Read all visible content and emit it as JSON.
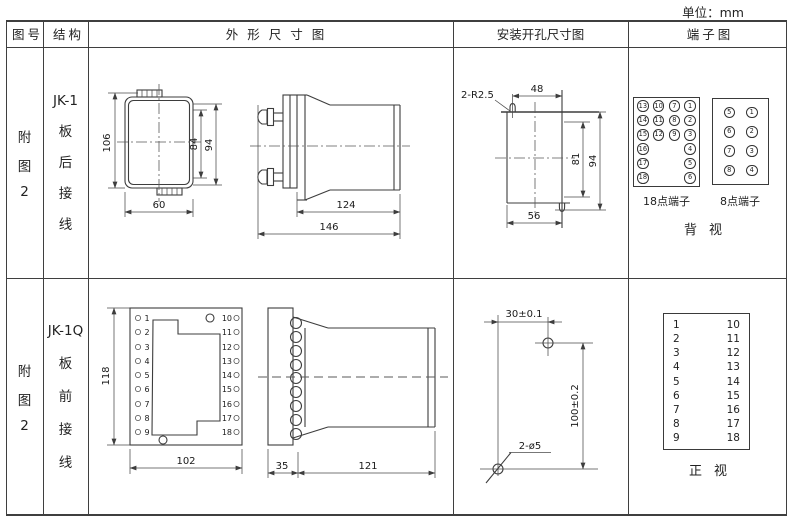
{
  "unit_label": "单位：mm",
  "header": {
    "figure_col": "图号",
    "structure_col": "结构",
    "outline_col": "外形尺寸图",
    "mounting_col": "安装开孔尺寸图",
    "terminal_col": "端子图"
  },
  "row1": {
    "figure_no": [
      "附",
      "图",
      "2"
    ],
    "structure": [
      "JK-1",
      "板",
      "后",
      "接",
      "线"
    ],
    "outline_dims": {
      "total_height": "106",
      "inner_height": "84",
      "outer_height": "94",
      "front_width": "60",
      "body_depth": "124",
      "total_depth": "146"
    },
    "mounting_dims": {
      "slot_note": "2-R2.5",
      "top_width": "48",
      "inner_height": "81",
      "outer_height": "94",
      "bottom_width": "56"
    },
    "terminal18": {
      "label": "18点端子",
      "grid": [
        [
          "13",
          "10",
          "7",
          "1"
        ],
        [
          "14",
          "11",
          "8",
          "2"
        ],
        [
          "15",
          "12",
          "9",
          "3"
        ],
        [
          "16",
          "",
          "",
          "4"
        ],
        [
          "17",
          "",
          "",
          "5"
        ],
        [
          "18",
          "",
          "",
          "6"
        ]
      ]
    },
    "terminal8": {
      "label": "8点端子",
      "grid": [
        [
          "5",
          "1"
        ],
        [
          "6",
          "2"
        ],
        [
          "7",
          "3"
        ],
        [
          "8",
          "4"
        ]
      ]
    },
    "view_label": "背视"
  },
  "row2": {
    "figure_no": [
      "附",
      "图",
      "2"
    ],
    "structure": [
      "JK-1Q",
      "板",
      "前",
      "接",
      "线"
    ],
    "outline_dims": {
      "front_height": "118",
      "front_width": "102",
      "flange_depth": "35",
      "body_depth": "121"
    },
    "front_terminals": {
      "left": [
        "1",
        "2",
        "3",
        "4",
        "5",
        "6",
        "7",
        "8",
        "9"
      ],
      "right": [
        "10",
        "11",
        "12",
        "13",
        "14",
        "15",
        "16",
        "17",
        "18"
      ]
    },
    "mounting_dims": {
      "hole_spacing_x": "30±0.1",
      "hole_spacing_y": "100±0.2",
      "hole_note": "2-ø5"
    },
    "terminal_table": {
      "left": [
        "1",
        "2",
        "3",
        "4",
        "5",
        "6",
        "7",
        "8",
        "9"
      ],
      "right": [
        "10",
        "11",
        "12",
        "13",
        "14",
        "15",
        "16",
        "17",
        "18"
      ]
    },
    "view_label": "正视"
  }
}
